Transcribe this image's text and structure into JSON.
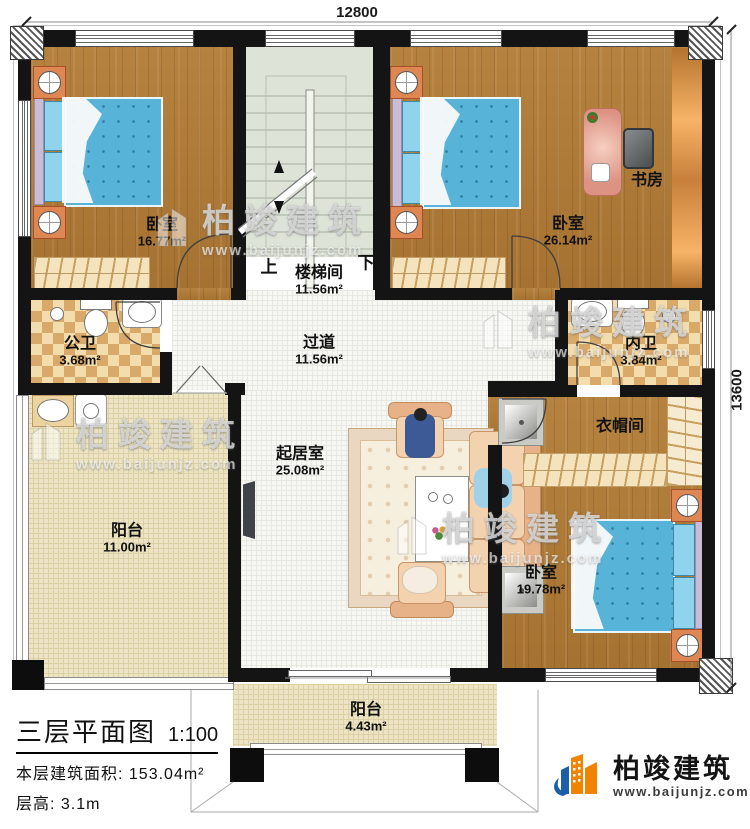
{
  "dimensions": {
    "top": "12800",
    "right": "13600"
  },
  "stair": {
    "up": "上",
    "down": "下"
  },
  "rooms": {
    "bedroom_tl": {
      "name": "卧室",
      "area": "16.77m²"
    },
    "stairwell": {
      "name": "楼梯间",
      "area": "11.56m²"
    },
    "bedroom_tr": {
      "name": "卧室",
      "area": "26.14m²"
    },
    "study": {
      "name": "书房"
    },
    "public_bath": {
      "name": "公卫",
      "area": "3.68m²"
    },
    "corridor": {
      "name": "过道",
      "area": "11.56m²"
    },
    "inner_bath": {
      "name": "内卫",
      "area": "3.84m²"
    },
    "living": {
      "name": "起居室",
      "area": "25.08m²"
    },
    "balcony_left": {
      "name": "阳台",
      "area": "11.00m²"
    },
    "cloakroom": {
      "name": "衣帽间"
    },
    "bedroom_br": {
      "name": "卧室",
      "area": "19.78m²"
    },
    "balcony_bottom": {
      "name": "阳台",
      "area": "4.43m²"
    }
  },
  "title_block": {
    "title": "三层平面图",
    "scale": "1:100",
    "area_label": "本层建筑面积:",
    "area_value": "153.04m²",
    "floor_height_label": "层高:",
    "floor_height_value": "3.1m"
  },
  "watermark": {
    "brand": "柏竣建筑",
    "url": "www.baijunjz.com"
  },
  "logo": {
    "brand": "柏竣建筑",
    "url": "www.baijunjz.com"
  },
  "colors": {
    "logo_orange": "#f08300",
    "logo_blue": "#1b5fa8",
    "wood": "#ae7a37",
    "bed_blue": "#57b4d8"
  }
}
